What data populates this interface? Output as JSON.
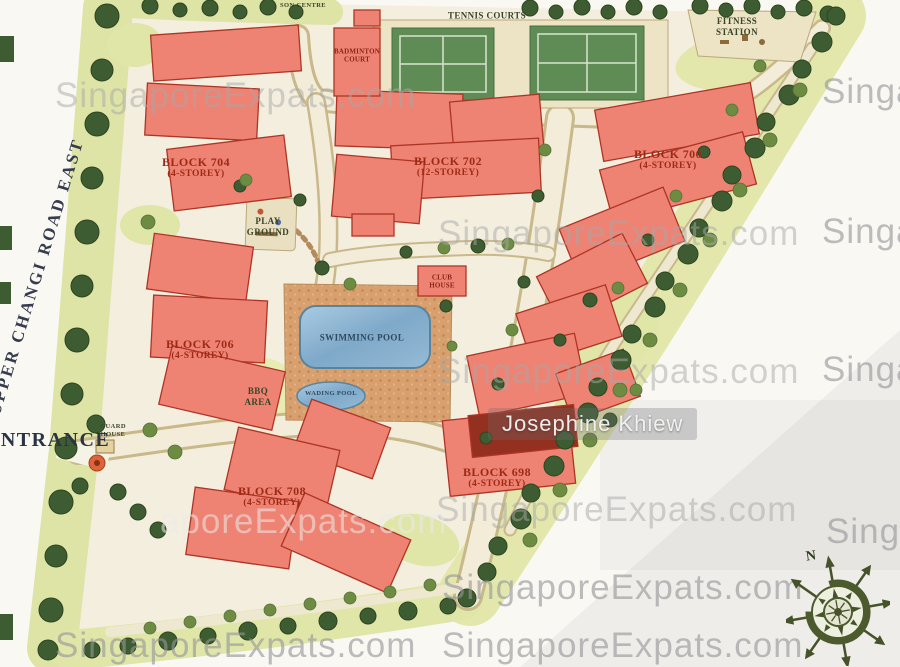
{
  "credit": {
    "name": "Josephine Khiew"
  },
  "watermark": {
    "text": "SingaporeExpats.com",
    "frag_right": "Singa",
    "frag_mid": "aporeExpats.com"
  },
  "road": {
    "name": "UPPER CHANGI ROAD EAST"
  },
  "entrance": {
    "label": "ENTRANCE"
  },
  "compass": {
    "north": "N"
  },
  "facilities": {
    "centre": "SON CENTRE",
    "badminton": {
      "line1": "BADMINTON",
      "line2": "COURT"
    },
    "tennis": "TENNIS COURTS",
    "fitness": {
      "line1": "FITNESS",
      "line2": "STATION"
    },
    "playground": {
      "line1": "PLAY",
      "line2": "GROUND"
    },
    "clubhouse": {
      "line1": "CLUB",
      "line2": "HOUSE"
    },
    "pool": "SWIMMING POOL",
    "wading": "WADING POOL",
    "bbq": {
      "line1": "BBQ",
      "line2": "AREA"
    },
    "guard": {
      "line1": "GUARD",
      "line2": "HOUSE"
    }
  },
  "blocks": [
    {
      "id": "704",
      "name": "BLOCK 704",
      "storey": "(4-STOREY)"
    },
    {
      "id": "702",
      "name": "BLOCK 702",
      "storey": "(12-STOREY)"
    },
    {
      "id": "700",
      "name": "BLOCK 700",
      "storey": "(4-STOREY)"
    },
    {
      "id": "706",
      "name": "BLOCK 706",
      "storey": "(4-STOREY)"
    },
    {
      "id": "708",
      "name": "BLOCK 708",
      "storey": "(4-STOREY)"
    },
    {
      "id": "698",
      "name": "BLOCK 698",
      "storey": "(4-STOREY)"
    }
  ],
  "colors": {
    "paper": "#FAF8F3",
    "site_ground": "#F3EEDE",
    "building": "#EE8373",
    "building_outline": "#AE3425",
    "building_shadow": "#93301F",
    "label_red": "#9E2A16",
    "pool_blue": "#7FA9C9",
    "court_green": "#5F8B55",
    "lawn": "#E2E6A4",
    "tree_dark": "#3E5C31",
    "tree_light": "#6E8B42",
    "road_cream": "#F2ECD8",
    "deck_terracotta": "#D7A06E",
    "watermark_gray": "#A8A8A8"
  }
}
